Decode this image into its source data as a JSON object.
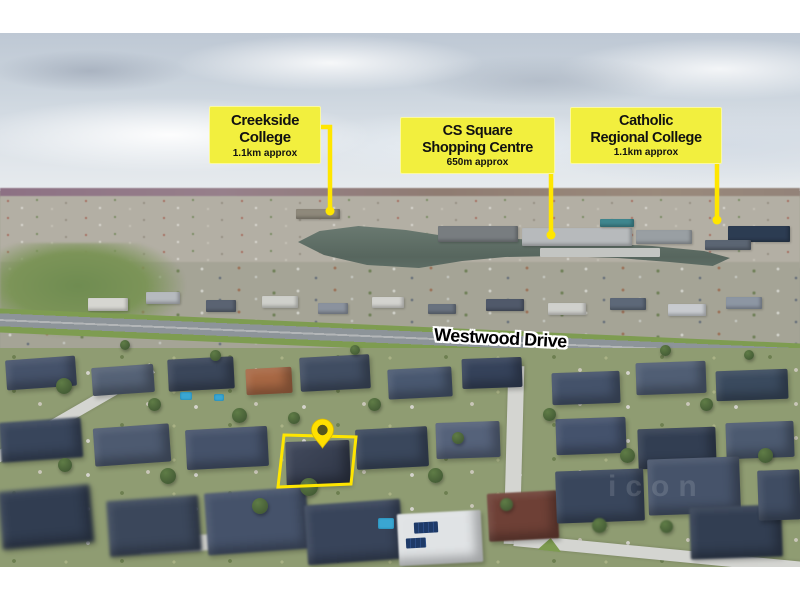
{
  "callouts": [
    {
      "id": "creekside-college",
      "line1": "Creekside",
      "line2": "College",
      "distance": "1.1km approx"
    },
    {
      "id": "cs-square-shopping-centre",
      "line1": "CS Square",
      "line2": "Shopping Centre",
      "distance": "650m approx"
    },
    {
      "id": "catholic-regional-college",
      "line1": "Catholic",
      "line2": "Regional College",
      "distance": "1.1km approx"
    }
  ],
  "road_label": "Westwood Drive",
  "watermark": "icon",
  "colors": {
    "callout_bg": "#f2ef3e",
    "callout_border": "#fbf9a0",
    "callout_text": "#111111",
    "accent_yellow": "#ffe600",
    "pin_yellow": "#ffdf00",
    "road_text": "#000000",
    "road_halo": "#ffffff"
  }
}
